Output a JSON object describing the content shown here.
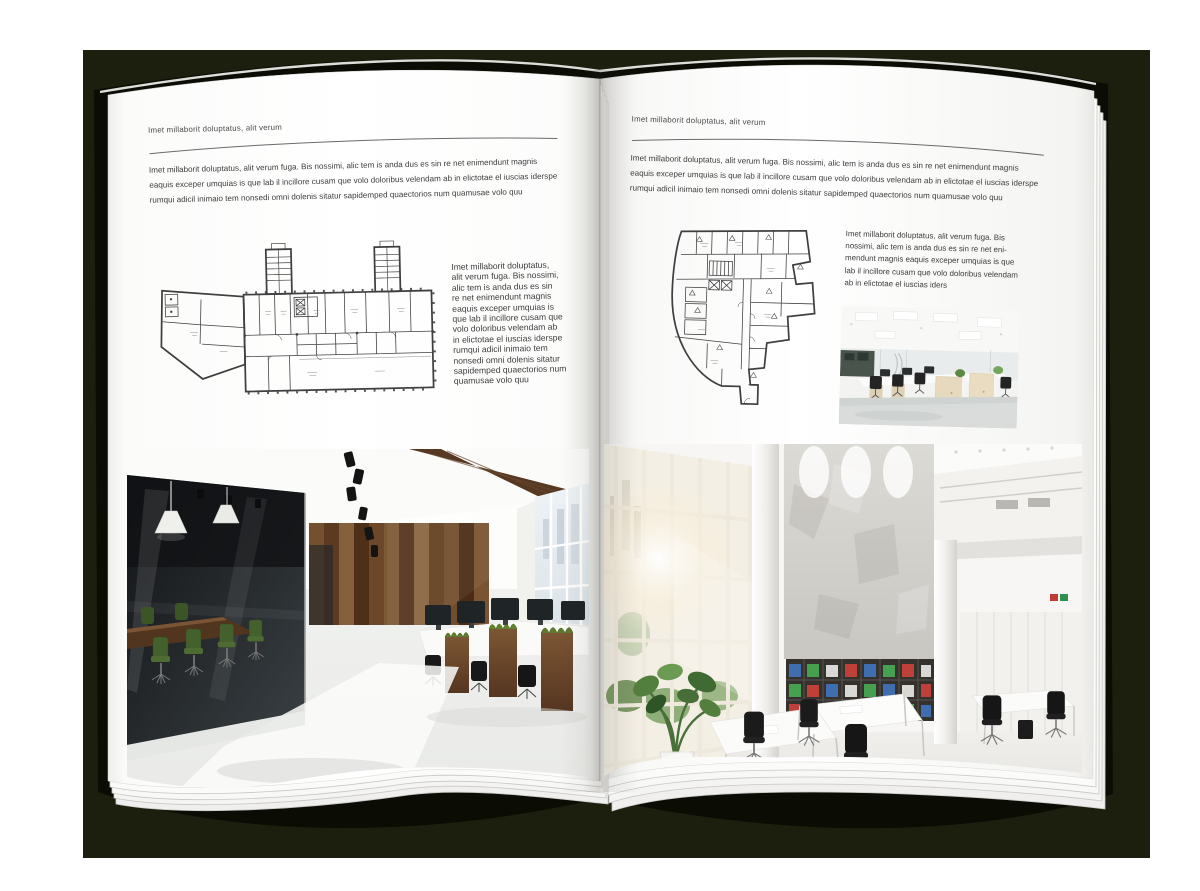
{
  "colors": {
    "backdrop": "#1c1f0e",
    "book_cover": "#0b0d04",
    "page": "#ffffff",
    "body_text": "#3c3c3c",
    "rule_line": "#666666",
    "plan_line": "#3f3f3f",
    "wood_accent": "#6a4427",
    "chair_green": "#4d6b33",
    "binder_blue": "#3e6db0",
    "binder_green": "#45a04f",
    "binder_red": "#bf4038"
  },
  "left_page": {
    "header": "Imet millaborit doluptatus, alit verum",
    "intro_lines": [
      "Imet millaborit doluptatus, alit verum fuga. Bis nossimi, alic tem is anda dus es sin re net enimendunt magnis",
      "eaquis exceper umquias is que lab il incillore cusam que volo doloribus velendam ab in elictotae el iuscias iderspe",
      "rumqui adicil inimaio tem nonsedi omni dolenis sitatur sapidemped quaectorios num quamusae volo quu"
    ],
    "side_lines": [
      "Imet millaborit doluptatus,",
      "alit verum fuga. Bis nossimi,",
      "alic tem is anda dus es sin",
      "re net enimendunt magnis",
      "eaquis exceper umquias is",
      "que lab il incillore cusam que",
      "volo doloribus velendam ab",
      "in elictotae el iuscias iderspe",
      "rumqui adicil inimaio tem",
      "nonsedi omni dolenis sitatur",
      "sapidemped quaectorios num",
      "quamusae volo quu"
    ]
  },
  "right_page": {
    "header": "Imet millaborit doluptatus, alit verum",
    "intro_lines": [
      "Imet millaborit doluptatus, alit verum fuga. Bis nossimi, alic tem is anda dus es sin re net enimendunt magnis",
      "eaquis exceper umquias is que lab il incillore cusam que volo doloribus velendam ab in elictotae el iuscias iderspe",
      "rumqui adicil inimaio tem nonsedi omni dolenis sitatur sapidemped quaectorios num quamusae volo quu"
    ],
    "side_lines": [
      "Imet millaborit doluptatus, alit verum fuga. Bis",
      "nossimi, alic tem is anda dus es sin re net eni-",
      "mendunt magnis eaquis exceper umquias is que",
      "lab il incillore cusam que volo doloribus velendam",
      "ab in elictotae el iuscias iders"
    ]
  }
}
